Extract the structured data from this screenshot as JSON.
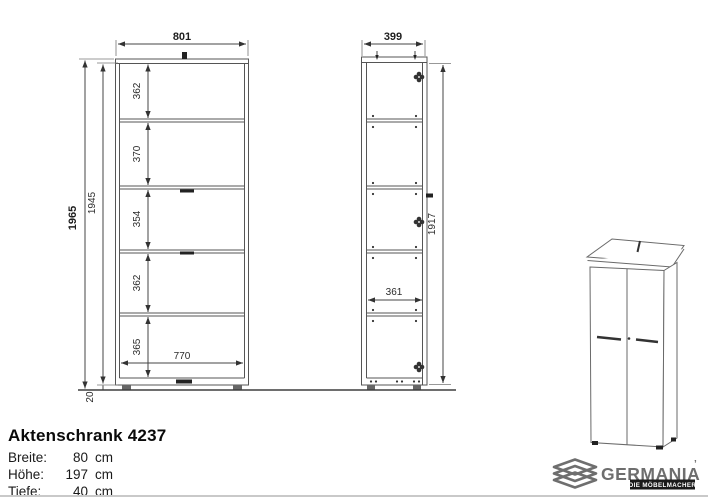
{
  "product": {
    "title": "Aktenschrank 4237",
    "specs": [
      {
        "label": "Breite:",
        "value": "80",
        "unit": "cm"
      },
      {
        "label": "Höhe:",
        "value": "197",
        "unit": "cm"
      },
      {
        "label": "Tiefe:",
        "value": "40",
        "unit": "cm"
      }
    ]
  },
  "front_view": {
    "dim_width_outer": "801",
    "dim_width_inner": "770",
    "dim_height_outer": "1965",
    "dim_height_carcass": "1945",
    "dim_plinth": "20",
    "compartments": [
      "362",
      "370",
      "354",
      "362",
      "365"
    ]
  },
  "side_view": {
    "dim_depth_outer": "399",
    "dim_depth_inner": "361",
    "dim_door_height": "1917"
  },
  "logo": {
    "brand": "GERMANIA",
    "mark": "’",
    "tagline": "DIE MÖBELMACHER"
  },
  "colors": {
    "drawing_line": "#555555",
    "dimension_text": "#2b2b2b",
    "floor_line": "#3f3f3f",
    "logo_grey": "#6e6e6e",
    "badge_black": "#1a1a1a",
    "separator": "#c9c9c9",
    "background": "#ffffff"
  }
}
